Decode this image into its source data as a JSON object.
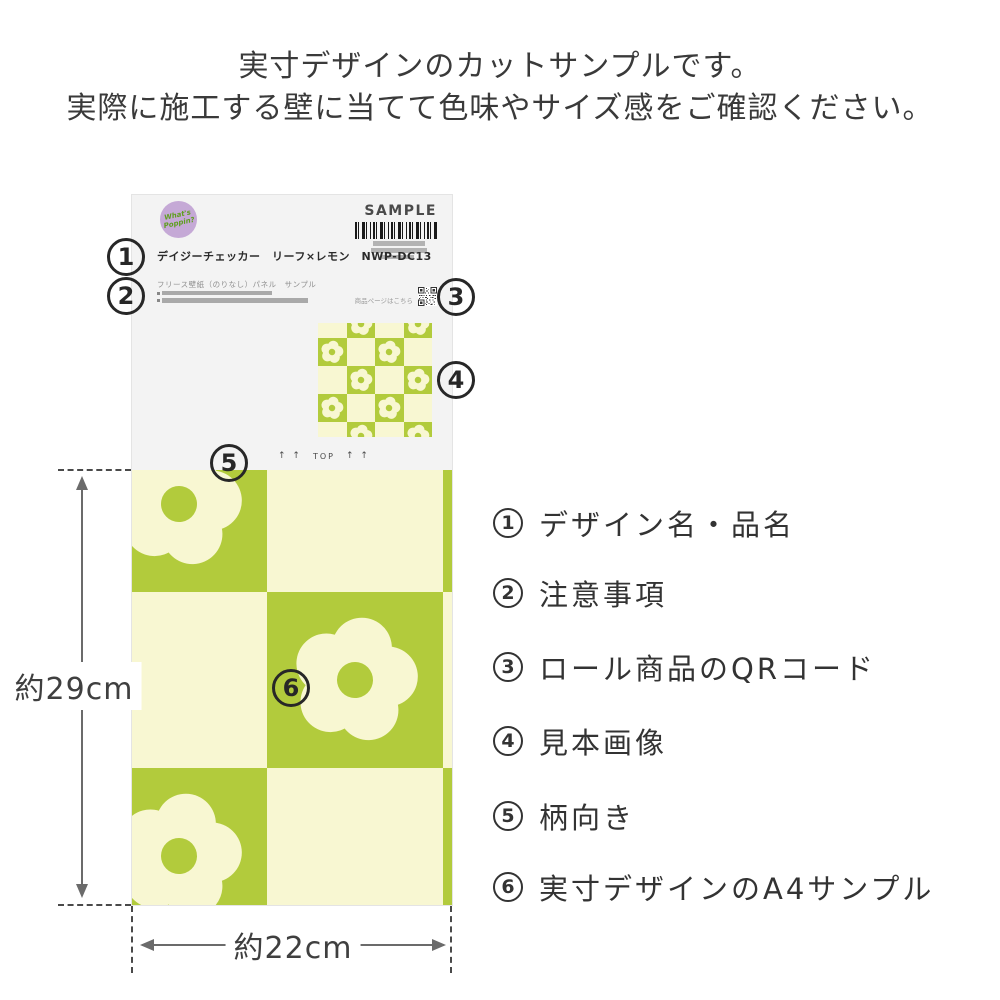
{
  "heading": {
    "line1": "実寸デザインのカットサンプルです。",
    "line2": "実際に施工する壁に当てて色味やサイズ感をご確認ください。"
  },
  "paper": {
    "brand_logo": "What's Poppin?",
    "sample_label": "SAMPLE",
    "product_name": "デイジーチェッカー　リーフ×レモン　NWP-DC13",
    "product_type": "フリース壁紙（のりなし）パネル　サンプル",
    "qr_caption": "商品ページはこちら",
    "top_marker": {
      "arrows_left": "↑ ↑",
      "label": "TOP",
      "arrows_right": "↑ ↑"
    }
  },
  "dimensions": {
    "height_label": "約29cm",
    "width_label": "約22cm"
  },
  "callouts": {
    "c1": "1",
    "c2": "2",
    "c3": "3",
    "c4": "4",
    "c5": "5",
    "c6": "6"
  },
  "legend": {
    "items": [
      {
        "number": "1",
        "label": "デザイン名・品名"
      },
      {
        "number": "2",
        "label": "注意事項"
      },
      {
        "number": "3",
        "label": "ロール商品のQRコード"
      },
      {
        "number": "4",
        "label": "見本画像"
      },
      {
        "number": "5",
        "label": "柄向き"
      },
      {
        "number": "6",
        "label": "実寸デザインのA4サンプル"
      }
    ]
  },
  "colors": {
    "pattern_green": "#b2cb3c",
    "pattern_cream": "#f8f7d2",
    "logo_purple": "#c5a9d6",
    "logo_text_green": "#5f9e1e"
  }
}
